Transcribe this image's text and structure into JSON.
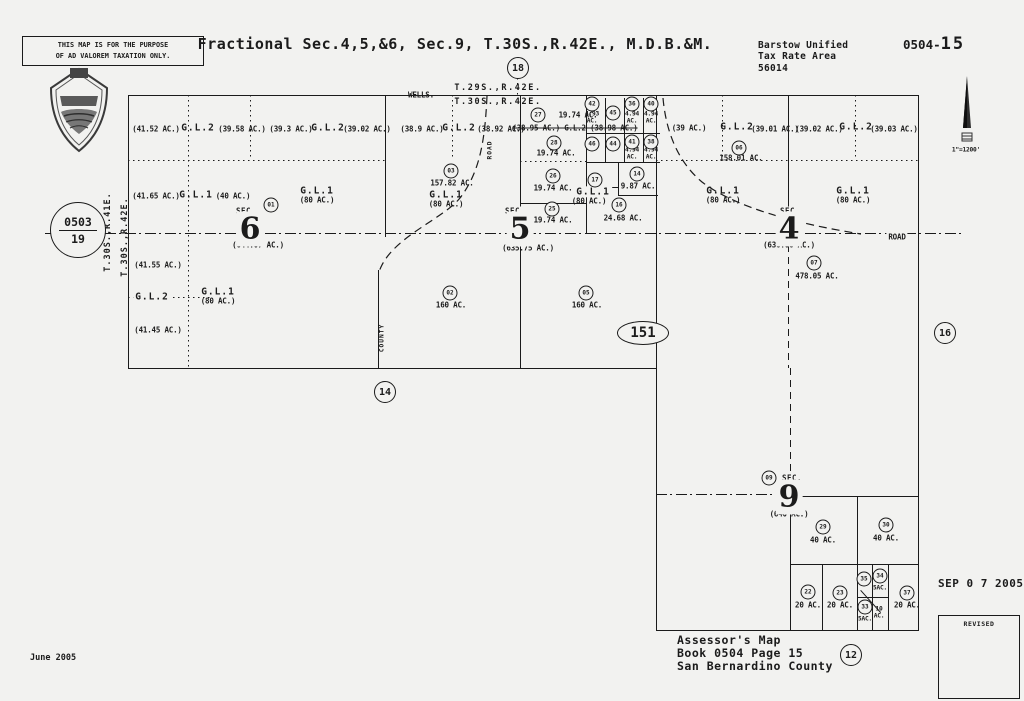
{
  "document": {
    "disclaimer": [
      "THIS MAP IS FOR THE PURPOSE",
      "OF AD VALOREM TAXATION ONLY."
    ],
    "title": "Fractional Sec.4,5,&6, Sec.9, T.30S.,R.42E., M.D.B.&M.",
    "tax_area": {
      "district": "Barstow Unified",
      "label": "Tax Rate Area",
      "code": "56014"
    },
    "sheet": {
      "prefix": "0504-",
      "number": "15"
    },
    "adjacent_sheet_circle": {
      "book": "0503",
      "page": "19"
    },
    "highway_ellipse": "151",
    "footer": {
      "line1": "Assessor's Map",
      "line2": "Book 0504 Page 15",
      "line3": "San Bernardino County",
      "date": "June 2005",
      "stamp": "SEP 0 7 2005",
      "revised": "REVISED"
    }
  },
  "map": {
    "labels": [
      {
        "t": "WELLS.",
        "x": 421,
        "y": 95
      },
      {
        "t": "T.29S.,R.42E.",
        "x": 498,
        "y": 88,
        "c": "twp"
      },
      {
        "t": "T.30S.,R.42E.",
        "x": 498,
        "y": 102,
        "c": "twp"
      },
      {
        "t": "T.30S.,R.41E.",
        "x": 108,
        "y": 232,
        "c": "twp vert"
      },
      {
        "t": "T.30S.,R.42E.",
        "x": 125,
        "y": 237,
        "c": "twp vert"
      },
      {
        "t": "1\"=1200'",
        "x": 966,
        "y": 150,
        "c": "xs"
      },
      {
        "t": "(41.52 AC.)",
        "x": 156,
        "y": 129
      },
      {
        "t": "G.L.2",
        "x": 198,
        "y": 128,
        "c": "gl"
      },
      {
        "t": "(39.58 AC.)",
        "x": 242,
        "y": 129
      },
      {
        "t": "(39.3 AC.)",
        "x": 291,
        "y": 129
      },
      {
        "t": "G.L.2",
        "x": 328,
        "y": 128,
        "c": "gl"
      },
      {
        "t": "(39.02 AC.)",
        "x": 367,
        "y": 129
      },
      {
        "t": "(41.65 AC.)",
        "x": 156,
        "y": 196
      },
      {
        "t": "G.L.1",
        "x": 196,
        "y": 195,
        "c": "gl"
      },
      {
        "t": "(40 AC.)",
        "x": 233,
        "y": 196
      },
      {
        "t": "G.L.1",
        "x": 317,
        "y": 191,
        "c": "gl"
      },
      {
        "t": "(80 AC.)",
        "x": 317,
        "y": 200
      },
      {
        "t": "SEC.",
        "x": 246,
        "y": 211,
        "c": "sec"
      },
      {
        "t": "6",
        "x": 250,
        "y": 229,
        "c": "big"
      },
      {
        "t": "(644.07 AC.)",
        "x": 258,
        "y": 245
      },
      {
        "t": "(41.55 AC.)",
        "x": 158,
        "y": 265
      },
      {
        "t": "G.L.2",
        "x": 152,
        "y": 297,
        "c": "gl bgm"
      },
      {
        "t": "G.L.1",
        "x": 218,
        "y": 292,
        "c": "gl"
      },
      {
        "t": "(80 AC.)",
        "x": 218,
        "y": 301
      },
      {
        "t": "(41.45 AC.)",
        "x": 158,
        "y": 330
      },
      {
        "t": "(38.9 AC.)",
        "x": 422,
        "y": 129
      },
      {
        "t": "G.L.2",
        "x": 459,
        "y": 128,
        "c": "gl"
      },
      {
        "t": "(38.92 AC.)",
        "x": 501,
        "y": 129
      },
      {
        "t": "ROAD",
        "x": 490,
        "y": 150,
        "c": "vert xs"
      },
      {
        "t": "157.82 AC.",
        "x": 452,
        "y": 183
      },
      {
        "t": "G.L.1",
        "x": 446,
        "y": 195,
        "c": "gl"
      },
      {
        "t": "(80 AC.)",
        "x": 446,
        "y": 204
      },
      {
        "t": "SEC.",
        "x": 515,
        "y": 211,
        "c": "sec"
      },
      {
        "t": "5",
        "x": 520,
        "y": 229,
        "c": "big"
      },
      {
        "t": "(635.75 AC.)",
        "x": 528,
        "y": 248
      },
      {
        "t": "160 AC.",
        "x": 451,
        "y": 305
      },
      {
        "t": "160 AC.",
        "x": 587,
        "y": 305
      },
      {
        "t": "COUNTY",
        "x": 382,
        "y": 338,
        "c": "vert xs"
      },
      {
        "t": "19.74 AC.",
        "x": 578,
        "y": 115
      },
      {
        "t": "(38.95 AC.) G.L.2 (38.98 AC.)",
        "x": 575,
        "y": 128,
        "c": "strike"
      },
      {
        "t": "19.74 AC.",
        "x": 556,
        "y": 153
      },
      {
        "t": "19.74 AC.",
        "x": 553,
        "y": 188
      },
      {
        "t": "19.74 AC.",
        "x": 553,
        "y": 220
      },
      {
        "t": "4.93\nAC.",
        "x": 592,
        "y": 118,
        "c": "xs"
      },
      {
        "t": "4.94\nAC.",
        "x": 632,
        "y": 118,
        "c": "xs"
      },
      {
        "t": "4.94\nAC.",
        "x": 651,
        "y": 118,
        "c": "xs"
      },
      {
        "t": "4.94\nAC.",
        "x": 632,
        "y": 154,
        "c": "xs"
      },
      {
        "t": "4.94\nAC.",
        "x": 651,
        "y": 154,
        "c": "xs"
      },
      {
        "t": "9.87 AC.",
        "x": 638,
        "y": 186
      },
      {
        "t": "G.L.1",
        "x": 593,
        "y": 192,
        "c": "gl bgm"
      },
      {
        "t": "(80 AC.)",
        "x": 589,
        "y": 201
      },
      {
        "t": "24.68 AC.",
        "x": 623,
        "y": 218
      },
      {
        "t": "(39 AC.)",
        "x": 689,
        "y": 128
      },
      {
        "t": "G.L.2",
        "x": 737,
        "y": 127,
        "c": "gl"
      },
      {
        "t": "(39.01 AC.)",
        "x": 775,
        "y": 129
      },
      {
        "t": "(39.02 AC.)",
        "x": 819,
        "y": 129
      },
      {
        "t": "G.L.2",
        "x": 856,
        "y": 127,
        "c": "gl"
      },
      {
        "t": "(39.03 AC.)",
        "x": 894,
        "y": 129
      },
      {
        "t": "158.01 AC.",
        "x": 741,
        "y": 158
      },
      {
        "t": "G.L.1",
        "x": 723,
        "y": 191,
        "c": "gl"
      },
      {
        "t": "(80 AC.)",
        "x": 723,
        "y": 200
      },
      {
        "t": "G.L.1",
        "x": 853,
        "y": 191,
        "c": "gl"
      },
      {
        "t": "(80 AC.)",
        "x": 853,
        "y": 200
      },
      {
        "t": "SEC.",
        "x": 790,
        "y": 211,
        "c": "sec"
      },
      {
        "t": "4",
        "x": 789,
        "y": 229,
        "c": "big"
      },
      {
        "t": "(636.06 AC.)",
        "x": 789,
        "y": 245
      },
      {
        "t": "478.05 AC.",
        "x": 817,
        "y": 276
      },
      {
        "t": "ROAD",
        "x": 897,
        "y": 237,
        "c": "bgm"
      },
      {
        "t": "SEC.",
        "x": 792,
        "y": 478,
        "c": "sec"
      },
      {
        "t": "9",
        "x": 789,
        "y": 497,
        "c": "big"
      },
      {
        "t": "(640 AC.)",
        "x": 789,
        "y": 514
      },
      {
        "t": "40 AC.",
        "x": 823,
        "y": 540
      },
      {
        "t": "40 AC.",
        "x": 886,
        "y": 538
      },
      {
        "t": "20 AC.",
        "x": 808,
        "y": 605
      },
      {
        "t": "20 AC.",
        "x": 840,
        "y": 605
      },
      {
        "t": "5AC.",
        "x": 880,
        "y": 588,
        "c": "xs"
      },
      {
        "t": "5AC.",
        "x": 865,
        "y": 619,
        "c": "xs"
      },
      {
        "t": "10\nAC.",
        "x": 879,
        "y": 613,
        "c": "xs"
      },
      {
        "t": "20 AC.",
        "x": 907,
        "y": 605
      }
    ],
    "parcel_circles": [
      {
        "n": "01",
        "x": 271,
        "y": 205
      },
      {
        "n": "03",
        "x": 451,
        "y": 171
      },
      {
        "n": "02",
        "x": 450,
        "y": 293
      },
      {
        "n": "05",
        "x": 586,
        "y": 293
      },
      {
        "n": "27",
        "x": 538,
        "y": 115
      },
      {
        "n": "28",
        "x": 554,
        "y": 143
      },
      {
        "n": "26",
        "x": 553,
        "y": 176
      },
      {
        "n": "25",
        "x": 552,
        "y": 209
      },
      {
        "n": "42",
        "x": 592,
        "y": 104
      },
      {
        "n": "45",
        "x": 613,
        "y": 113
      },
      {
        "n": "36",
        "x": 632,
        "y": 104
      },
      {
        "n": "40",
        "x": 651,
        "y": 104
      },
      {
        "n": "46",
        "x": 592,
        "y": 144
      },
      {
        "n": "44",
        "x": 613,
        "y": 144
      },
      {
        "n": "41",
        "x": 632,
        "y": 142
      },
      {
        "n": "38",
        "x": 651,
        "y": 142
      },
      {
        "n": "17",
        "x": 595,
        "y": 180
      },
      {
        "n": "14",
        "x": 637,
        "y": 174
      },
      {
        "n": "16",
        "x": 619,
        "y": 205
      },
      {
        "n": "06",
        "x": 739,
        "y": 148
      },
      {
        "n": "07",
        "x": 814,
        "y": 263
      },
      {
        "n": "09",
        "x": 769,
        "y": 478
      },
      {
        "n": "29",
        "x": 823,
        "y": 527
      },
      {
        "n": "30",
        "x": 886,
        "y": 525
      },
      {
        "n": "22",
        "x": 808,
        "y": 592
      },
      {
        "n": "23",
        "x": 840,
        "y": 593
      },
      {
        "n": "35",
        "x": 864,
        "y": 579
      },
      {
        "n": "34",
        "x": 880,
        "y": 576
      },
      {
        "n": "33",
        "x": 865,
        "y": 607
      },
      {
        "n": "37",
        "x": 907,
        "y": 593
      },
      {
        "n": "18",
        "x": 518,
        "y": 68,
        "big": true
      },
      {
        "n": "14",
        "x": 385,
        "y": 392,
        "big": true
      },
      {
        "n": "16",
        "x": 945,
        "y": 333,
        "big": true
      },
      {
        "n": "12",
        "x": 851,
        "y": 655,
        "big": true
      }
    ]
  }
}
